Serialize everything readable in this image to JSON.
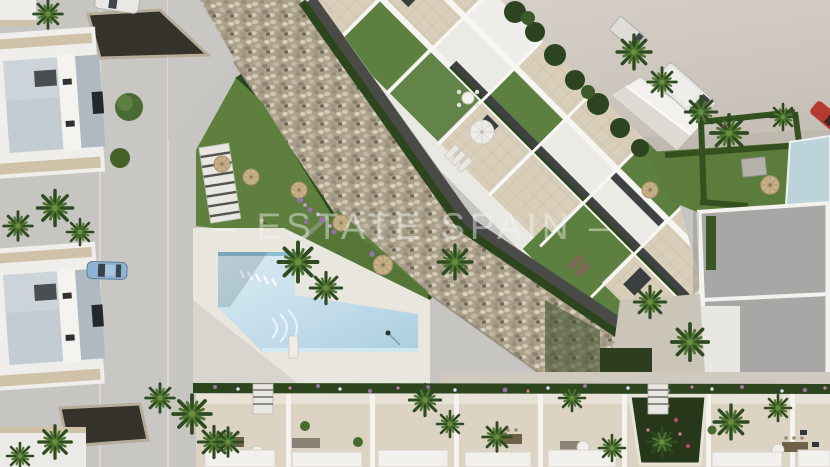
{
  "meta": {
    "type": "aerial-3d-architectural-render",
    "description": "Top-down render of a Mediterranean residential complex: white townhouses, central apartment block with roof terraces, communal lap pool, palm gardens, stone embankment, roads and parked vehicles"
  },
  "watermark": {
    "text": "– ESTATE SPAIN –",
    "color": "#f6f7f7",
    "opacity": 0.45
  },
  "palette": {
    "road_gray": "#c7c5c1",
    "open_ground": "#d1cbc3",
    "building_white": "#efeeea",
    "terrace_tile": "#d8ceba",
    "roof_gray": "#a7a8a5",
    "roof_blue_gray": "#c3ccd3",
    "lawn_green": "#5e7f3d",
    "hedge_green": "#2c451c",
    "stone_beige": "#aba089",
    "pool_water": "#bfdcea",
    "pool_deck": "#e9e6de",
    "parasol_tan": "#c8b189",
    "asphalt_dark": "#4a4a47",
    "van_white": "#e6e5e2",
    "car_blue": "#8fb3d4",
    "car_red": "#b73a30",
    "flower_purple": "#9a6fae"
  },
  "scene": {
    "elements": [
      "left-townhouses",
      "access-road",
      "gravel-beds",
      "stone-embankment",
      "apartment-block",
      "roof-terraces",
      "swimming-pool",
      "pool-deck",
      "garden-lawns",
      "palm-trees",
      "parasols",
      "bottom-townhouses",
      "villa",
      "white-van",
      "box-truck",
      "red-car",
      "blue-car",
      "white-car"
    ]
  }
}
